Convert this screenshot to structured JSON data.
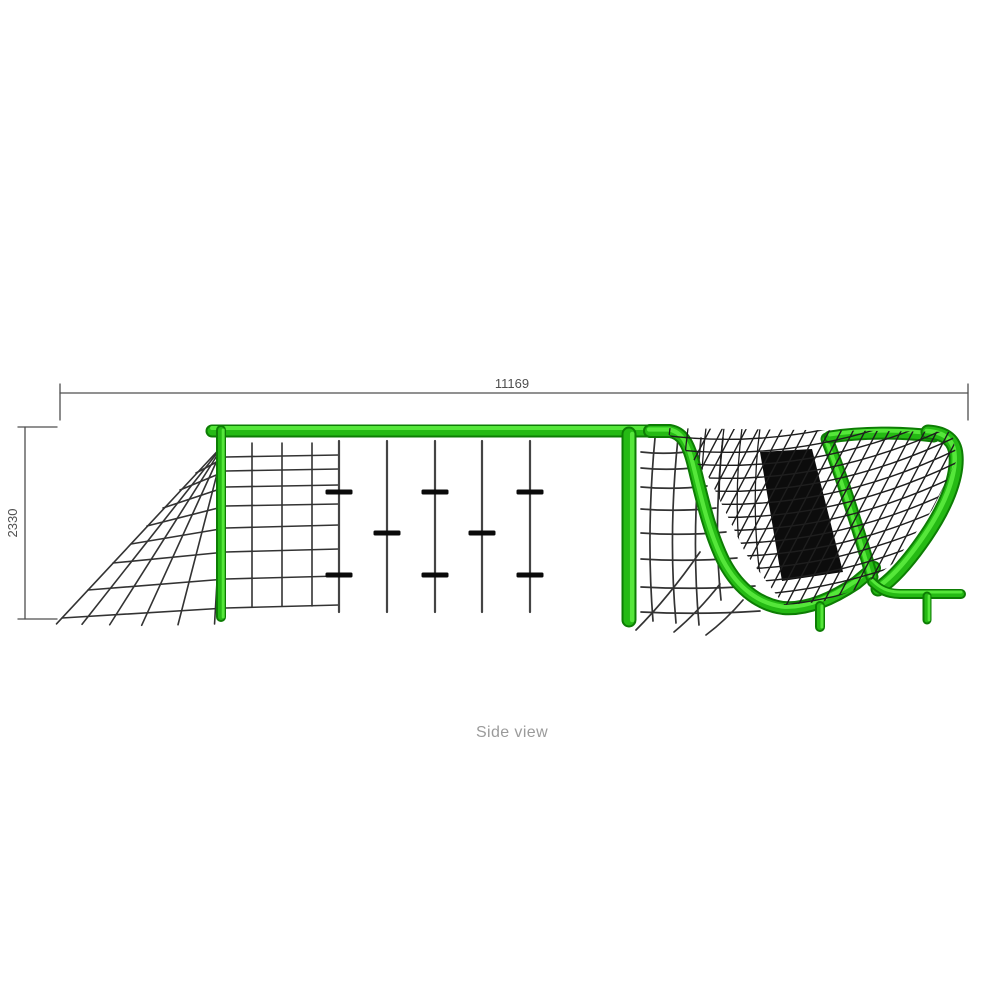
{
  "title": {
    "side_view_label": "Side view"
  },
  "dimensions": {
    "width_mm": "11169",
    "height_mm": "2330"
  },
  "colors": {
    "background": "#ffffff",
    "green_dark": "#0d7d04",
    "green_mid": "#25ba14",
    "green_light": "#55e73a",
    "dim_line": "#4f4f4f",
    "net_line": "#333333",
    "rope_line": "#444444",
    "clamp_black": "#0a0a0a",
    "hatch_black": "#1e1e1e",
    "panel_black": "#0c0c0c",
    "label_gray": "#9b9b9b"
  }
}
